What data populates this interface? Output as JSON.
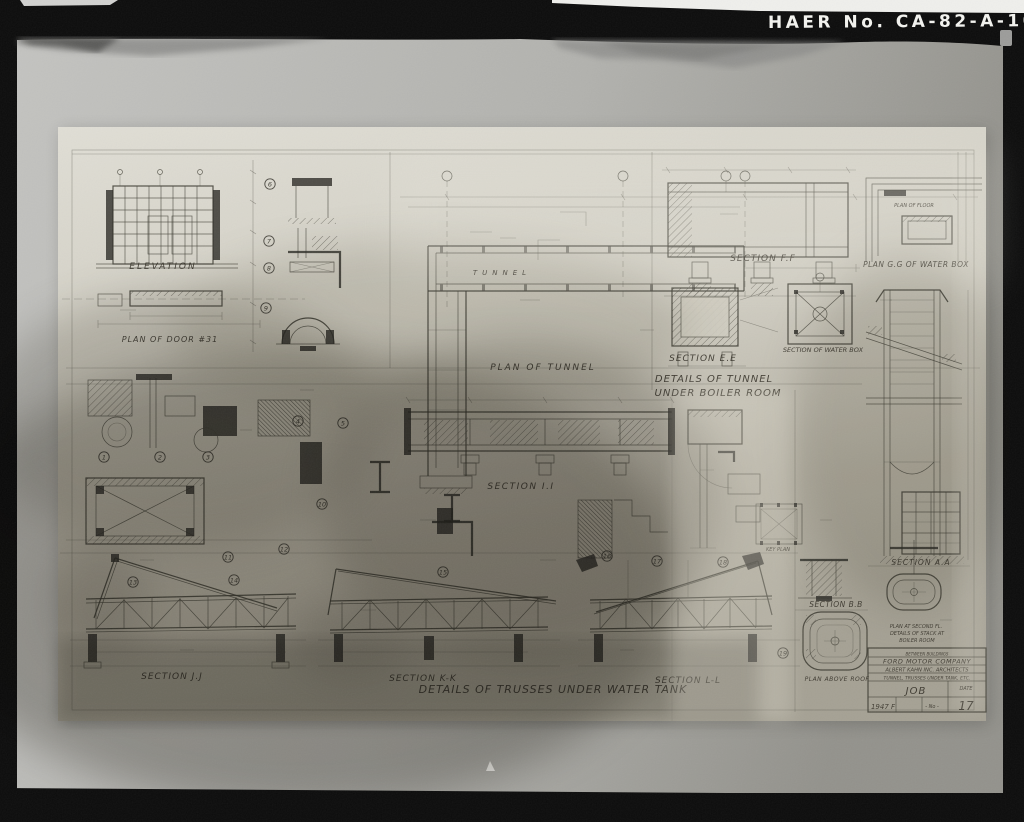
{
  "photo": {
    "archive_label": "HAER No. CA-82-A-108",
    "colors": {
      "film": "#0c0c0c",
      "mat_light": "#c0c0bd",
      "mat_dark": "#95948e",
      "paper": "#dedcd2",
      "paper_stain": "#6f6c63",
      "ink": "#3a382f",
      "label_white": "#f2f2ee"
    }
  },
  "sheet": {
    "drawing_labels": [
      {
        "id": "elevation",
        "text": "ELEVATION",
        "x": 163,
        "y": 269,
        "fs": 9,
        "ls": 2
      },
      {
        "id": "plan-of-door",
        "text": "PLAN OF DOOR  #31",
        "x": 170,
        "y": 342,
        "fs": 8,
        "ls": 1
      },
      {
        "id": "tunnel",
        "text": "TUNNEL",
        "x": 502,
        "y": 275,
        "fs": 7,
        "ls": 5
      },
      {
        "id": "plan-of-tunnel",
        "text": "PLAN OF TUNNEL",
        "x": 543,
        "y": 370,
        "fs": 9,
        "ls": 2
      },
      {
        "id": "section-f-f",
        "text": "SECTION F.F",
        "x": 763,
        "y": 261,
        "fs": 9,
        "ls": 1
      },
      {
        "id": "plan-of-floor",
        "text": "PLAN OF FLOOR",
        "x": 914,
        "y": 207,
        "fs": 5,
        "ls": 0
      },
      {
        "id": "plan-g-g",
        "text": "PLAN G.G OF WATER BOX",
        "x": 916,
        "y": 267,
        "fs": 7.5,
        "ls": 0.5
      },
      {
        "id": "section-e-e",
        "text": "SECTION E.E",
        "x": 703,
        "y": 361,
        "fs": 9,
        "ls": 1
      },
      {
        "id": "section-of-water-box",
        "text": "SECTION OF WATER BOX",
        "x": 823,
        "y": 352,
        "fs": 6.5,
        "ls": 0
      },
      {
        "id": "details-of-tunnel",
        "text": "DETAILS OF TUNNEL",
        "x": 714,
        "y": 382,
        "fs": 10,
        "ls": 1
      },
      {
        "id": "under-boiler-room",
        "text": "UNDER BOILER ROOM",
        "x": 718,
        "y": 396,
        "fs": 10,
        "ls": 1
      },
      {
        "id": "section-a-a",
        "text": "SECTION A.A",
        "x": 921,
        "y": 565,
        "fs": 7.5,
        "ls": 1
      },
      {
        "id": "section-i-i",
        "text": "SECTION I.I",
        "x": 521,
        "y": 489,
        "fs": 9,
        "ls": 1.5
      },
      {
        "id": "key-plan",
        "text": "KEY PLAN",
        "x": 778,
        "y": 551,
        "fs": 5,
        "ls": 0
      },
      {
        "id": "section-j-j",
        "text": "SECTION J.J",
        "x": 172,
        "y": 679,
        "fs": 9,
        "ls": 1
      },
      {
        "id": "section-k-k",
        "text": "SECTION K-K",
        "x": 423,
        "y": 681,
        "fs": 9,
        "ls": 1
      },
      {
        "id": "details-of-trusses",
        "text": "DETAILS OF TRUSSES UNDER WATER TANK",
        "x": 553,
        "y": 693,
        "fs": 11,
        "ls": 1
      },
      {
        "id": "section-l-l",
        "text": "SECTION L-L",
        "x": 688,
        "y": 683,
        "fs": 9,
        "ls": 1
      },
      {
        "id": "section-b-b",
        "text": "SECTION B.B",
        "x": 836,
        "y": 607,
        "fs": 7.5,
        "ls": 0.5
      },
      {
        "id": "plan-at-second-fl",
        "text": "PLAN AT SECOND FL.",
        "x": 916,
        "y": 628,
        "fs": 5,
        "ls": 0
      },
      {
        "id": "details-of-stack-at",
        "text": "DETAILS OF STACK AT",
        "x": 917,
        "y": 635,
        "fs": 5,
        "ls": 0
      },
      {
        "id": "boiler-room",
        "text": "BOILER ROOM",
        "x": 917,
        "y": 642,
        "fs": 5,
        "ls": 0
      },
      {
        "id": "plan-above-roof",
        "text": "PLAN ABOVE ROOF",
        "x": 837,
        "y": 681,
        "fs": 6,
        "ls": 0.5
      },
      {
        "id": "tb-note",
        "text": "BETWEEN BUILDINGS",
        "x": 927,
        "y": 655.5,
        "fs": 4,
        "ls": 0
      },
      {
        "id": "tb-company",
        "text": "FORD MOTOR COMPANY",
        "x": 927,
        "y": 663.5,
        "fs": 6.5,
        "ls": 0.5
      },
      {
        "id": "tb-architects",
        "text": "ALBERT KAHN INC. ARCHITECTS",
        "x": 927,
        "y": 671.5,
        "fs": 5.2,
        "ls": 0
      },
      {
        "id": "tb-sheet-title",
        "text": "TUNNEL, TRUSSES UNDER TANK, ETC.",
        "x": 927,
        "y": 679.5,
        "fs": 4.6,
        "ls": 0
      },
      {
        "id": "tb-job",
        "text": "JOB",
        "x": 916,
        "y": 694,
        "fs": 10,
        "ls": 1
      },
      {
        "id": "tb-date",
        "text": "DATE",
        "x": 966,
        "y": 690,
        "fs": 5,
        "ls": 0
      },
      {
        "id": "tb-code",
        "text": "1947 F",
        "x": 883,
        "y": 709,
        "fs": 7,
        "ls": 0
      },
      {
        "id": "tb-no",
        "text": "- No -",
        "x": 932,
        "y": 708,
        "fs": 5,
        "ls": 0
      },
      {
        "id": "tb-sheet-no",
        "text": "17",
        "x": 966,
        "y": 710,
        "fs": 12,
        "ls": 0
      }
    ],
    "detail_markers": [
      {
        "n": "1",
        "x": 104,
        "y": 457
      },
      {
        "n": "2",
        "x": 160,
        "y": 457
      },
      {
        "n": "3",
        "x": 208,
        "y": 457
      },
      {
        "n": "4",
        "x": 298,
        "y": 421
      },
      {
        "n": "5",
        "x": 343,
        "y": 423
      },
      {
        "n": "6",
        "x": 270,
        "y": 184
      },
      {
        "n": "7",
        "x": 269,
        "y": 241
      },
      {
        "n": "8",
        "x": 269,
        "y": 268
      },
      {
        "n": "9",
        "x": 266,
        "y": 308
      },
      {
        "n": "10",
        "x": 322,
        "y": 504
      },
      {
        "n": "11",
        "x": 228,
        "y": 557
      },
      {
        "n": "12",
        "x": 284,
        "y": 549
      },
      {
        "n": "13",
        "x": 133,
        "y": 582
      },
      {
        "n": "14",
        "x": 234,
        "y": 580
      },
      {
        "n": "15",
        "x": 443,
        "y": 572
      },
      {
        "n": "16",
        "x": 607,
        "y": 556
      },
      {
        "n": "17",
        "x": 657,
        "y": 561
      },
      {
        "n": "18",
        "x": 723,
        "y": 562
      },
      {
        "n": "19",
        "x": 783,
        "y": 653
      }
    ]
  }
}
